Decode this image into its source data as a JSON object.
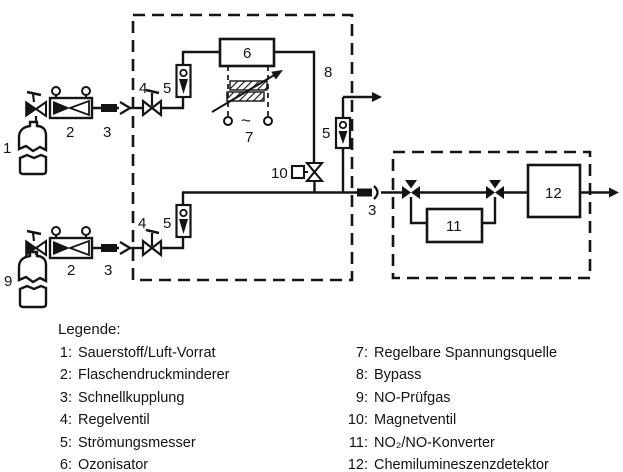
{
  "diagram": {
    "labels": {
      "o2_cylinder": "1",
      "o2_reducer": "2",
      "o2_coupling": "3",
      "o2_valve": "4",
      "o2_flowmeter": "5",
      "ozonator": "6",
      "voltage_source": "7",
      "ac_symbol": "~",
      "bypass": "8",
      "bypass_flowmeter": "5",
      "no_cylinder": "9",
      "no_reducer": "2",
      "no_coupling": "3",
      "no_valve": "4",
      "no_flowmeter": "5",
      "magnet_valve": "10",
      "main_coupling": "3",
      "converter": "11",
      "detector": "12"
    }
  },
  "legend": {
    "title": "Legende:",
    "left": [
      {
        "num": "1:",
        "label": "Sauerstoff/Luft-Vorrat"
      },
      {
        "num": "2:",
        "label": "Flaschendruckminderer"
      },
      {
        "num": "3:",
        "label": "Schnellkupplung"
      },
      {
        "num": "4:",
        "label": "Regelventil"
      },
      {
        "num": "5:",
        "label": "Strömungsmesser"
      },
      {
        "num": "6:",
        "label": "Ozonisator"
      }
    ],
    "right": [
      {
        "num": "7:",
        "label": "Regelbare Spannungsquelle"
      },
      {
        "num": "8:",
        "label": "Bypass"
      },
      {
        "num": "9:",
        "label": "NO-Prüfgas"
      },
      {
        "num": "10:",
        "label": "Magnetventil"
      },
      {
        "num": "11:",
        "label": "NO₂/NO-Konverter"
      },
      {
        "num": "12:",
        "label": "Chemilumineszenzdetektor"
      }
    ]
  },
  "colors": {
    "ink": "#141414",
    "background": "#ffffff"
  }
}
